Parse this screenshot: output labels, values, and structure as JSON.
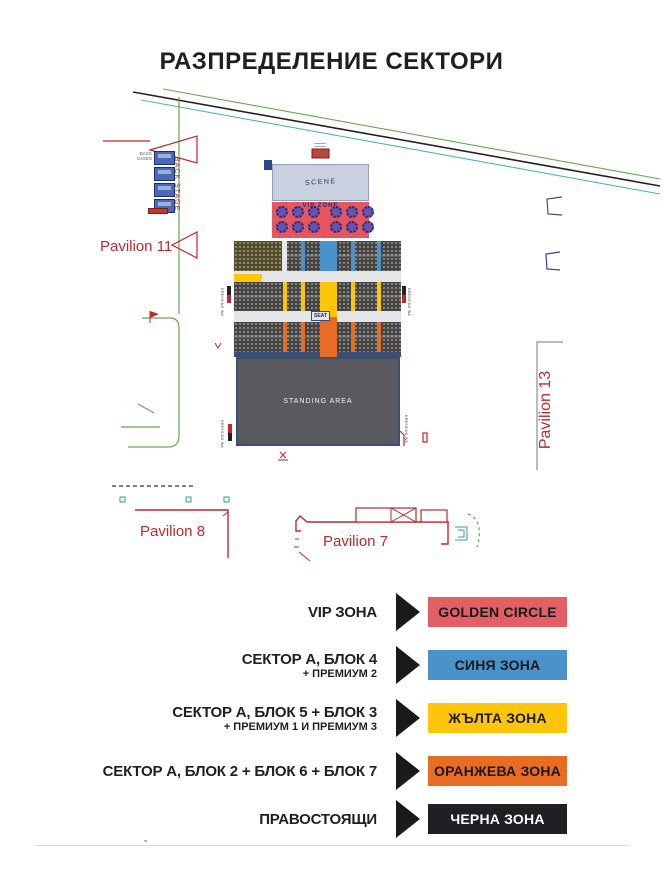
{
  "title": "РАЗПРЕДЕЛЕНИЕ СЕКТОРИ",
  "map": {
    "scene_label": "SCENE",
    "vip_zone_label": "VIP ZONE",
    "standing_label": "STANDING AREA",
    "seat_label": "SEAT",
    "backstage_label": "BACK STAGE",
    "back_cases_label": "BACK CASES",
    "dressing_label": "DRESSING WA",
    "pavilion_11": "Pavilion 11",
    "pavilion_13": "Pavilion 13",
    "pavilion_8": "Pavilion 8",
    "pavilion_7": "Pavilion 7",
    "colors": {
      "stage": "#c9d1e0",
      "vip_red": "#e8555c",
      "blue": "#4a92c9",
      "yellow": "#fec50b",
      "orange": "#e86c24",
      "standing_gray": "#595a5e",
      "seat_block": "#43444a",
      "seat_block_olive": "#4d4b33",
      "navy": "#3c4f72",
      "map_red": "#c1272d",
      "green_line": "#63a950",
      "teal_line": "#4db8b0",
      "aisle_gray": "#e4e5e7"
    }
  },
  "legend": {
    "arrow_color": "#1a1a1a",
    "rows": [
      {
        "label": "VIP ЗОНА",
        "sublabel": "",
        "zone": "GOLDEN CIRCLE",
        "color": "#e25f66",
        "text_color": "#1a1a1a"
      },
      {
        "label": "СЕКТОР А, БЛОК 4",
        "sublabel": "+ ПРЕМИУМ 2",
        "zone": "СИНЯ ЗОНА",
        "color": "#4a92c9",
        "text_color": "#1a1a1a"
      },
      {
        "label": "СЕКТОР А, БЛОК 5 + БЛОК 3",
        "sublabel": "+ ПРЕМИУМ 1 И ПРЕМИУМ 3",
        "zone": "ЖЪЛТА ЗОНА",
        "color": "#fec50b",
        "text_color": "#1a1a1a"
      },
      {
        "label": "СЕКТОР А, БЛОК 2 + БЛОК 6 + БЛОК 7",
        "sublabel": "",
        "zone": "ОРАНЖЕВА ЗОНА",
        "color": "#e86c24",
        "text_color": "#1a1a1a"
      },
      {
        "label": "ПРАВОСТОЯЩИ",
        "sublabel": "",
        "zone": "ЧЕРНА ЗОНА",
        "color": "#202024",
        "text_color": "#ffffff"
      }
    ]
  }
}
